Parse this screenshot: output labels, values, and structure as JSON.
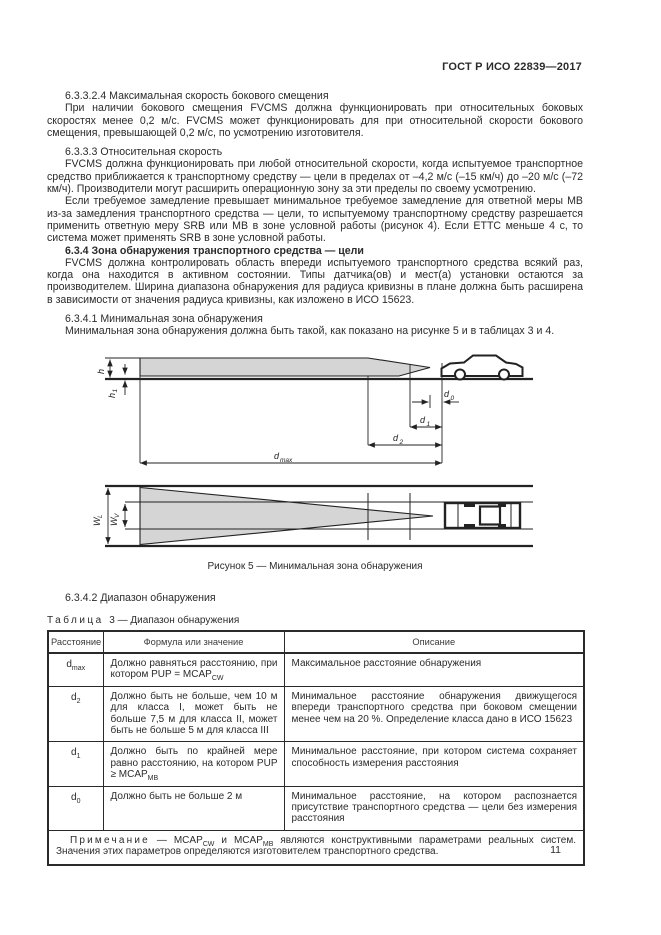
{
  "page": {
    "doc_code": "ГОСТ Р ИСО 22839—2017",
    "page_number": "11"
  },
  "colors": {
    "zone_fill": "#d5d5d5",
    "ink": "#262626"
  },
  "paragraphs": [
    {
      "text": "6.3.3.2.4 Максимальная скорость бокового смещения"
    },
    {
      "text": "При наличии бокового смещения FVCMS должна функционировать при относительных боковых скоростях менее 0,2 м/с. FVCMS может функционировать для при относительной скорости бокового смещения, превышающей 0,2 м/с, по усмотрению изготовителя."
    },
    {
      "text": "6.3.3.3 Относительная скорость"
    },
    {
      "text": "FVCMS должна функционировать при любой относительной скорости, когда испытуемое транспортное средство приближается к транспортному средству — цели в пределах от –4,2 м/с (–15 км/ч) до –20 м/с (–72 км/ч). Производители могут расширить операционную зону за эти пределы по своему усмотрению."
    },
    {
      "text": "Если требуемое замедление превышает минимальное требуемое замедление для ответной меры МВ из-за замедления транспортного средства — цели, то испытуемому транспортному средству разрешается применить ответную меру SRB или МВ в зоне условной работы (рисунок 4). Если ЕТТС меньше 4 с, то система может применять SRB в зоне условной работы."
    },
    {
      "text": "6.3.4 Зона обнаружения транспортного средства — цели"
    },
    {
      "text": "FVCMS должна контролировать область впереди испытуемого транспортного средства всякий раз, когда она находится в активном состоянии. Типы датчика(ов) и мест(а) установки остаются за производителем. Ширина диапазона обнаружения для радиуса кривизны в плане должна быть расширена в зависимости от значения радиуса кривизны, как изложено в ИСО 15623."
    },
    {
      "text": "6.3.4.1 Минимальная зона обнаружения"
    },
    {
      "text": "Минимальная зона обнаружения должна быть такой, как показано на рисунке 5 и в таблицах 3 и 4."
    }
  ],
  "section_heading": "6.3.4.2 Диапазон обнаружения",
  "figure": {
    "caption": "Рисунок 5 — Минимальная зона обнаружения",
    "labels": {
      "h": "h",
      "h1_base": "h",
      "h1_sub": "1",
      "d0_base": "d",
      "d0_sub": "0",
      "d1_base": "d",
      "d1_sub": "1",
      "d2_base": "d",
      "d2_sub": "2",
      "dmax_base": "d",
      "dmax_sub": "max",
      "wl_base": "W",
      "wl_sub": "L",
      "wv_base": "W",
      "wv_sub": "V"
    }
  },
  "table": {
    "label_word": "Таблица",
    "label_rest": "3 — Диапазон обнаружения",
    "headers": [
      "Расстояние",
      "Формула или значение",
      "Описание"
    ],
    "rows": [
      {
        "sym": "d",
        "sub": "max",
        "formula": "Должно равняться расстоянию, при котором PUP = MCAP",
        "formula_sub": "CW",
        "desc": "Максимальное расстояние обнаружения"
      },
      {
        "sym": "d",
        "sub": "2",
        "formula": "Должно быть не больше, чем 10 м для класса I, может быть не больше 7,5 м для класса II, может быть не больше 5 м для класса III",
        "desc": "Минимальное расстояние обнаружения движущегося впереди транспортного средства при боковом смещении менее чем на 20 %. Определение класса дано в ИСО 15623"
      },
      {
        "sym": "d",
        "sub": "1",
        "formula": "Должно быть по крайней мере равно расстоянию, на котором PUP ≥ MCAP",
        "formula_sub": "MB",
        "desc": "Минимальное расстояние, при котором система сохраняет способность измерения расстояния"
      },
      {
        "sym": "d",
        "sub": "0",
        "formula": "Должно быть не больше 2 м",
        "desc": "Минимальное расстояние, на котором распознается присутствие транспортного средства — цели без измерения расстояния"
      }
    ],
    "note": {
      "label": "Примечание",
      "t1": " — MCAP",
      "s1": "CW",
      "t2": " и MCAP",
      "s2": "MB",
      "t3": " являются конструктивными параметрами реальных систем. Значения этих параметров определяются изготовителем транспортного средства."
    }
  }
}
